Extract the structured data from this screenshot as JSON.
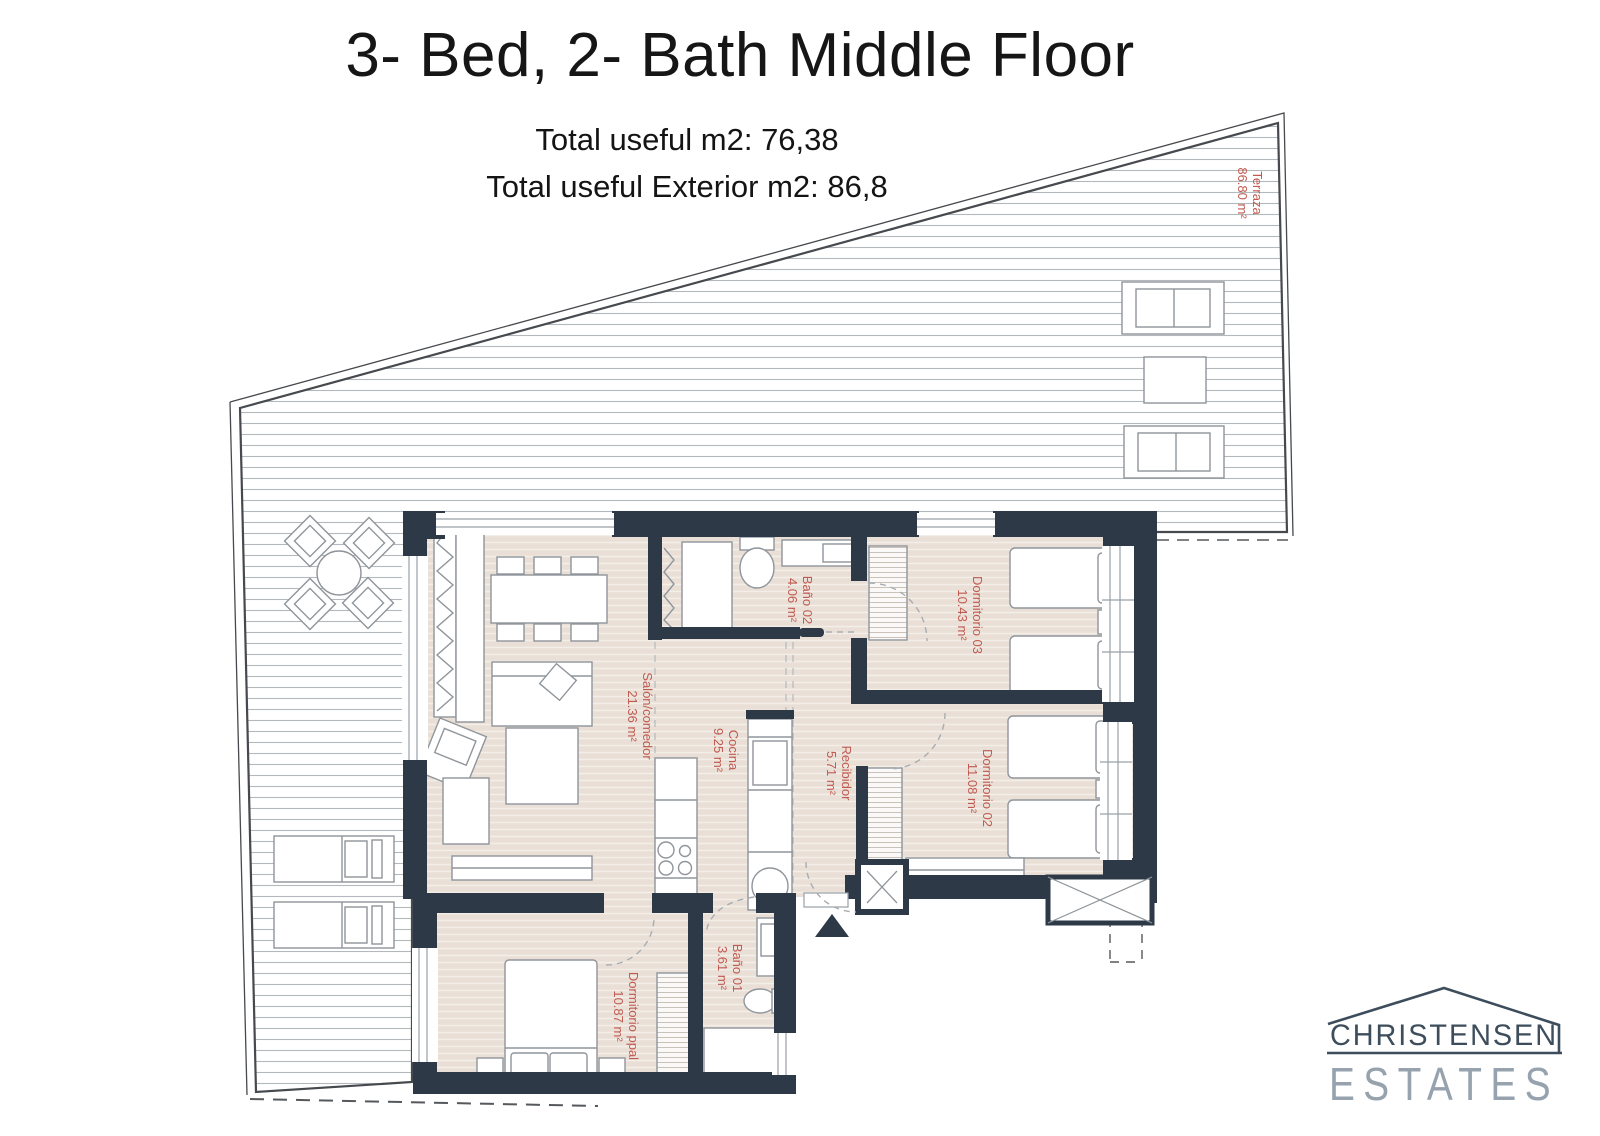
{
  "header": {
    "title": "3- Bed, 2- Bath Middle Floor",
    "subtitle1": "Total useful m2: 76,38",
    "subtitle2": "Total useful Exterior m2: 86,8"
  },
  "floorplan": {
    "label_color": "#c05a50",
    "wall_color": "#2e3947",
    "rooms": [
      {
        "id": "terraza",
        "name": "Terraza",
        "area": "86.80 m²"
      },
      {
        "id": "salon-comedor",
        "name": "Salón/comedor",
        "area": "21.36 m²"
      },
      {
        "id": "cocina",
        "name": "Cocina",
        "area": "9.25 m²"
      },
      {
        "id": "recibidor",
        "name": "Recibidor",
        "area": "5.71 m²"
      },
      {
        "id": "bano-02",
        "name": "Baño 02",
        "area": "4.06 m²"
      },
      {
        "id": "dormitorio-03",
        "name": "Dormitorio 03",
        "area": "10.43 m²"
      },
      {
        "id": "dormitorio-02",
        "name": "Dormitorio 02",
        "area": "11.08 m²"
      },
      {
        "id": "bano-01",
        "name": "Baño 01",
        "area": "3.61 m²"
      },
      {
        "id": "dormitorio-ppal",
        "name": "Dormitorio ppal",
        "area": "10.87 m²"
      }
    ]
  },
  "logo": {
    "line1": "CHRISTENSEN",
    "line2": "ESTATES"
  }
}
